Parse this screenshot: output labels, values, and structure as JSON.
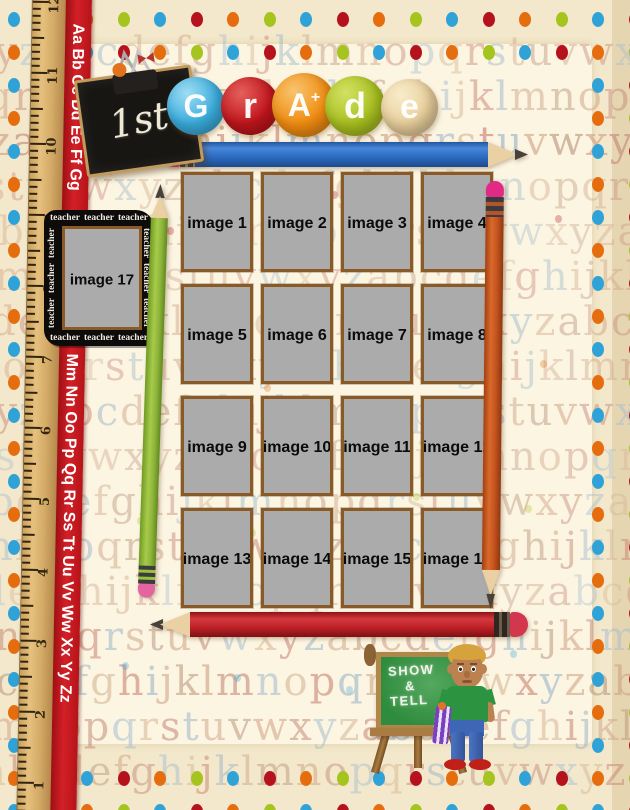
{
  "header": {
    "grade_prefix": "1st",
    "grade_circles": [
      {
        "letter": "G",
        "sup": "",
        "color": "#3aaede",
        "highlight": "#9fdcf2"
      },
      {
        "letter": "r",
        "sup": "",
        "color": "#c2151c",
        "highlight": "#e4605b"
      },
      {
        "letter": "A",
        "sup": "+",
        "color": "#f08c10",
        "highlight": "#f8c46e"
      },
      {
        "letter": "d",
        "sup": "",
        "color": "#a9c01f",
        "highlight": "#d2e163"
      },
      {
        "letter": "e",
        "sup": "",
        "color": "#e9cf9c",
        "highlight": "#f8ecca"
      }
    ]
  },
  "photo_grid": {
    "cells": [
      "image 1",
      "image 2",
      "image 3",
      "image 4",
      "image 5",
      "image 6",
      "image 7",
      "image 8",
      "image 9",
      "image 10",
      "image 11",
      "image 12",
      "image 13",
      "image 14",
      "image 15",
      "image 16"
    ]
  },
  "side_frame": {
    "label": "image 17",
    "word": "teacher"
  },
  "ruler": {
    "numbers": [
      "12",
      "11",
      "10",
      "9",
      "8",
      "7",
      "6",
      "5",
      "4",
      "3",
      "2",
      "1"
    ]
  },
  "ribbon": {
    "top_text": "Aa Bb Cc Dd Ee Ff Gg",
    "bottom_text": "Mm Nn Oo Pp Qq Rr Ss Tt Uu Vv Ww Xx Yy Zz"
  },
  "show_tell_board": {
    "line1": "SHOW",
    "line2": "&",
    "line3": "TELL"
  },
  "background": {
    "alphabet_row_a": "xyzabcdefghijklmnopqrstuvwxyzabcdefghijklm",
    "alphabet_row_b": "lmnopqrstuvwxyzabcdefghijklmnopqrstuvwxyzab",
    "dot_colors": [
      "#2fa3d8",
      "#b5121d",
      "#e66d0e",
      "#a6c41e"
    ],
    "letter_palette": [
      "#cfa183",
      "#c58c7b",
      "#a9bfcf",
      "#d6b795",
      "#c98374",
      "#9db6c9",
      "#d0a88b",
      "#bd9a80"
    ],
    "paper_color": "#fcf5e2",
    "base_color": "#f3e8cb"
  }
}
